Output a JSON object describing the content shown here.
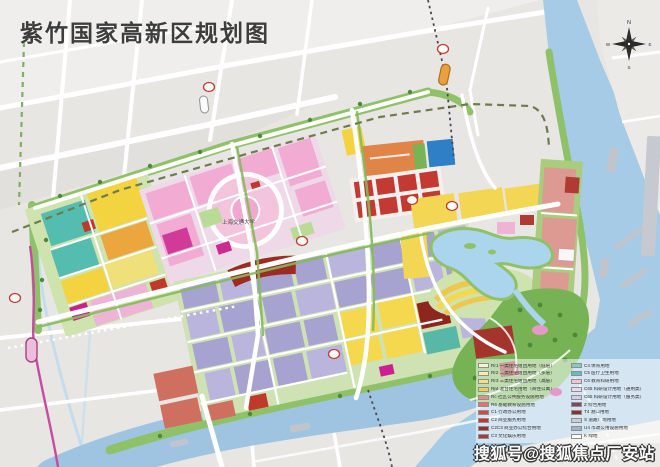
{
  "title": "紫竹国家高新区规划图",
  "watermark": {
    "text": "搜狐号@搜狐焦点厂安站"
  },
  "compass": {
    "n": "N",
    "e": "E",
    "s": "S",
    "w": "W"
  },
  "map_labels": {
    "university": "上海交通大学"
  },
  "legend": {
    "left": [
      {
        "label": "Rr1 一类住宅组团用地（低层）",
        "color": "#f8f3cd"
      },
      {
        "label": "Rr2 二类住宅组团用地（多层）",
        "color": "#f6eda6"
      },
      {
        "label": "Rr3 三类住宅组团用地（高层）",
        "color": "#f2e27b"
      },
      {
        "label": "Rr4 混合住宅用地（商住公寓）",
        "color": "#ecd14e"
      },
      {
        "label": "Rc 社区公共服务设施用地",
        "color": "#df9282"
      },
      {
        "label": "R6 基础教育设施用地",
        "color": "#e86f6f"
      },
      {
        "label": "C1 行政办公用地",
        "color": "#d14a41"
      },
      {
        "label": "C2 商业服务用地",
        "color": "#c0392b"
      },
      {
        "label": "C2C3 商业办公综合用地",
        "color": "#96302b"
      },
      {
        "label": "C3 文化娱乐用地",
        "color": "#a33b48"
      }
    ],
    "right": [
      {
        "label": "C4 体育用地",
        "color": "#7fccc0"
      },
      {
        "label": "C5 医疗卫生用地",
        "color": "#6fb6c9"
      },
      {
        "label": "C6 教育科研用地",
        "color": "#f2c4d2"
      },
      {
        "label": "C65 科研设计用地（通用类）",
        "color": "#e9d9ec"
      },
      {
        "label": "C65 科研设计用地（服务类）",
        "color": "#cdd0e8"
      },
      {
        "label": "Z 综合用地",
        "color": "#7a4a62"
      },
      {
        "label": "T4 港口用地",
        "color": "#8c2f2f"
      },
      {
        "label": "S 道路广场用地",
        "color": "#c9cdd4"
      },
      {
        "label": "U4 市政公用设施用地",
        "color": "#9fb4c9"
      },
      {
        "label": "K 绿地",
        "color": "#ffffff"
      }
    ]
  },
  "colors": {
    "base_gray": "#e8e6e3",
    "river_blue": "#a6cbe6",
    "lake_blue": "#aad5ec",
    "park_green": "#77b355",
    "street_green": "#8fc268",
    "residential_yellow": "#f3d74e",
    "research_purple": "#a7a3d1",
    "commercial_red": "#c23a32",
    "campus_pink": "#f2abd2",
    "industry_teal": "#55bdb0",
    "metro_magenta": "#c74ba0",
    "orange_block": "#e08448",
    "blue_block": "#2f7fc6"
  }
}
